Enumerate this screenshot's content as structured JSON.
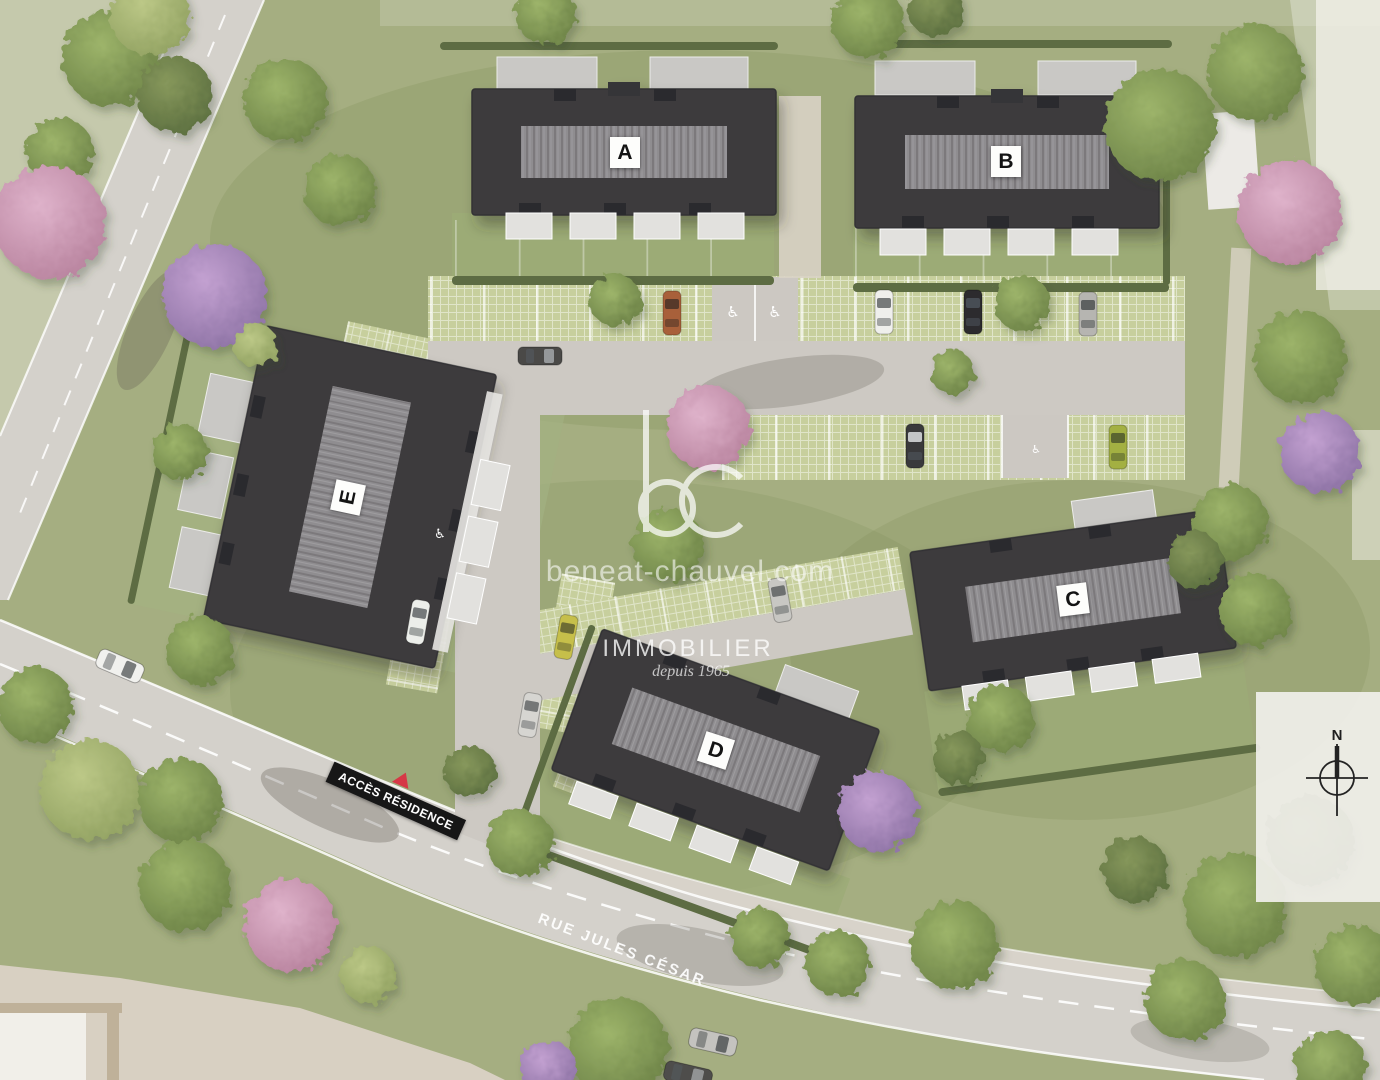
{
  "scene": {
    "type": "residence-aerial-site-plan"
  },
  "watermark": {
    "logo": "bc",
    "website": "beneat-chauvel.com",
    "brand": "IMMOBILIER",
    "tagline": "depuis 1965"
  },
  "buildings": [
    {
      "label": "A"
    },
    {
      "label": "B"
    },
    {
      "label": "C"
    },
    {
      "label": "D"
    },
    {
      "label": "E"
    }
  ],
  "signs": {
    "access_residence": "ACCÈS RÉSIDENCE",
    "street_name": "RUE JULES CÉSAR"
  },
  "compass": {
    "north_label": "N"
  },
  "icons": {
    "disabled_parking_icon": "♿"
  },
  "colors": {
    "grass": "#a5ae81",
    "road": "#d4d1cb",
    "sidewalk": "#d8d3ca",
    "parking_pavers": "#c7cf9d",
    "roof_dark": "#3d3b3e",
    "roof_ridge": "#8f8d90",
    "hedge": "#5d6c43",
    "access_banner": "#171717",
    "access_arrow": "#d63846",
    "label_bg": "#fdfdfb",
    "watermark_white": "#ffffff"
  }
}
